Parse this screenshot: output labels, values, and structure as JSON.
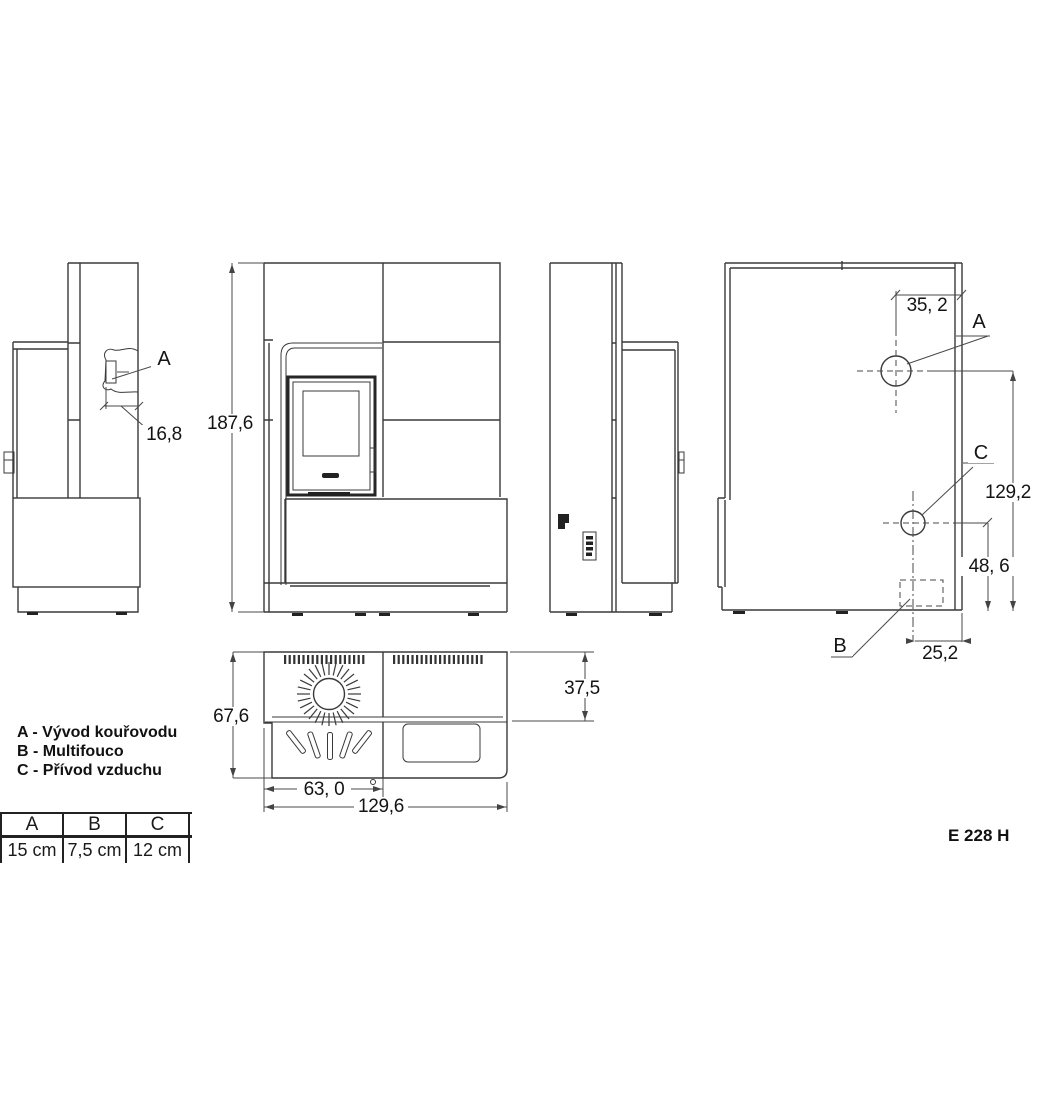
{
  "product_code": "E 228 H",
  "point_labels": {
    "a": "A",
    "b": "B",
    "c": "C"
  },
  "dims": {
    "side_outlet_depth": "16,8",
    "front_height": "187,6",
    "rear_a_offset": "35, 2",
    "rear_a_height": "129,2",
    "rear_c_height": "48, 6",
    "rear_b_offset": "25,2",
    "top_depth": "67,6",
    "top_rear_depth": "37,5",
    "top_left_width": "63, 0",
    "top_total_width": "129,6"
  },
  "legend": {
    "items": [
      {
        "text": "A - Vývod kouřovodu"
      },
      {
        "text": "B - Multifouco"
      },
      {
        "text": "C - Přívod vzduchu"
      }
    ]
  },
  "table": {
    "headers": [
      "A",
      "B",
      "C"
    ],
    "values": [
      "15 cm",
      "7,5 cm",
      "12 cm"
    ]
  }
}
